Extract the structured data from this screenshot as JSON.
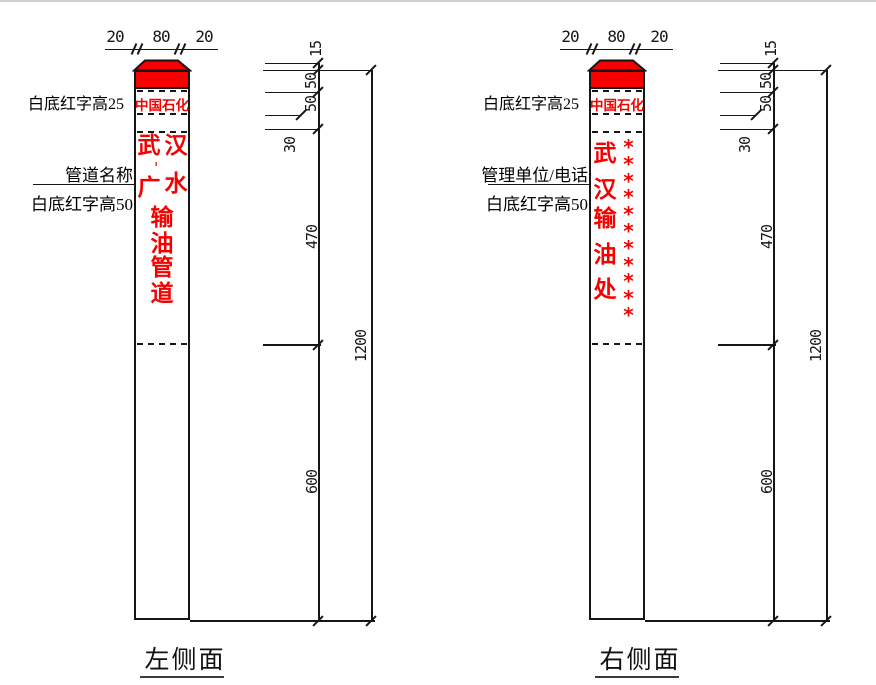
{
  "colors": {
    "marker_red": "#f60000",
    "line": "#161616"
  },
  "views": [
    {
      "caption": "左侧面",
      "top_dims": [
        "20",
        "80",
        "20"
      ],
      "brand": "中国石化",
      "cap_note": "白底红字高25",
      "pointer_label": "管道名称",
      "pointer_note": "白底红字高50",
      "name_pair_rows": [
        [
          "武",
          "汉"
        ],
        [
          "广",
          "水"
        ]
      ],
      "name_dash": "-",
      "name_column": [
        "输",
        "油",
        "管",
        "道"
      ],
      "chain_dims": [
        "15",
        "50",
        "50",
        "30",
        "470",
        "600"
      ],
      "overall_dim": "1200"
    },
    {
      "caption": "右侧面",
      "top_dims": [
        "20",
        "80",
        "20"
      ],
      "brand": "中国石化",
      "cap_note": "白底红字高25",
      "pointer_label": "管理单位/电话",
      "pointer_note": "白底红字高50",
      "name_column": [
        "武",
        "汉",
        "输",
        "油",
        "处"
      ],
      "phone_mask": [
        "*",
        "*",
        "*",
        "*",
        "*",
        "*",
        "*",
        "*",
        "*",
        "*",
        "*"
      ],
      "chain_dims": [
        "15",
        "50",
        "50",
        "30",
        "470",
        "600"
      ],
      "overall_dim": "1200"
    }
  ]
}
